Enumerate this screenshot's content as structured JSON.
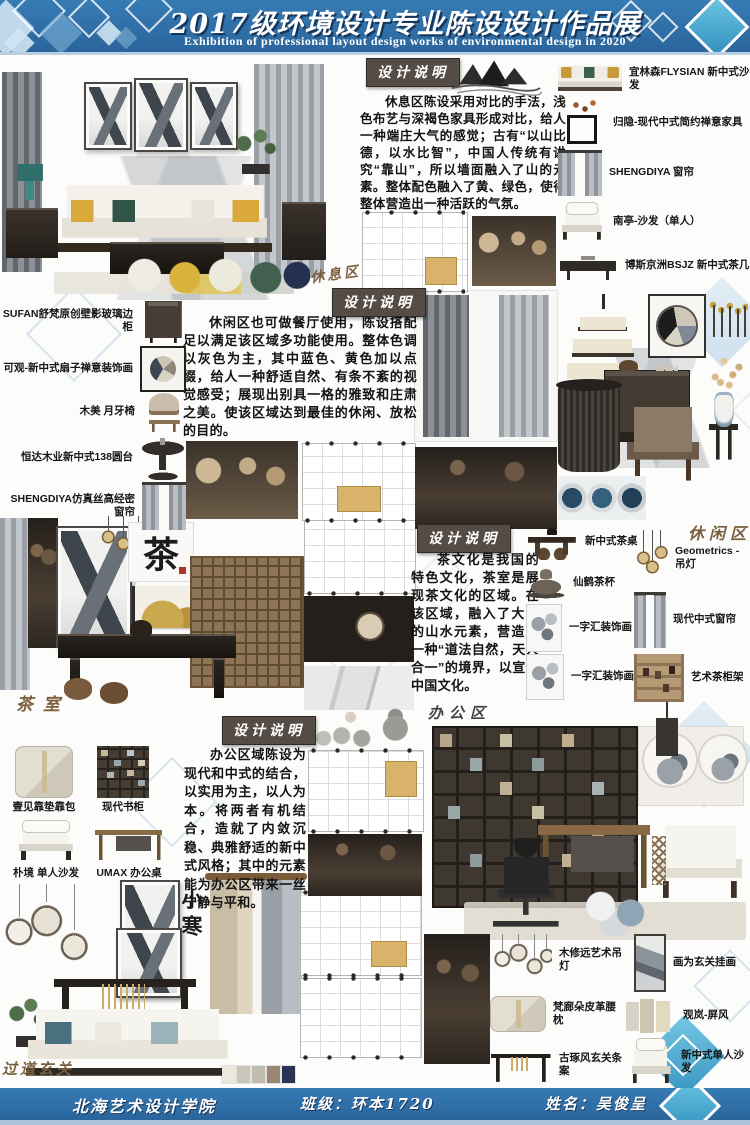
{
  "header": {
    "title": "2017级环境设计专业陈设设计作品展",
    "subtitle": "Exhibition of professional layout design works of environmental design in 2020"
  },
  "sections": {
    "rest_label": "休息区",
    "leisure_label": "休闲区",
    "tea_label": "茶室",
    "office_label": "办公区",
    "hallway_label": "过道玄关",
    "calligraphy_art": "茶",
    "solar_term_art": "小寒"
  },
  "design_notes": [
    {
      "title": "设计说明",
      "body": "休息区陈设采用对比的手法，浅色布艺与深褐色家具形成对比，给人一种端庄大气的感觉；古有“以山比德，以水比智”，中国人传统有讲究“靠山”，所以墙面融入了山的元素。整体配色融入了黄、绿色，使得整体营造出一种活跃的气氛。"
    },
    {
      "title": "设计说明",
      "body": "休闲区也可做餐厅使用，陈设搭配足以满足该区域多功能使用。整体色调以灰色为主，其中蓝色、黄色加以点缀，给人一种舒适自然、有条不紊的视觉感受；展现出别具一格的雅致和庄肃之美。使该区域达到最佳的休闲、放松的目的。"
    },
    {
      "title": "设计说明",
      "body": "茶文化是我国的特色文化，茶室是展现茶文化的区域。在该区域，融入了大量的山水元素，营造出一种“道法自然，天人合一”的境界，以宣传中国文化。"
    },
    {
      "title": "设计说明",
      "body": "办公区域陈设为现代和中式的结合，以实用为主，以人为本。将两者有机结合，造就了内敛沉稳、典雅舒适的新中式风格；其中的元素能为办公区带来一丝宁静与平和。"
    }
  ],
  "products": {
    "rest_right": [
      {
        "label": "宜林森FLYSIAN 新中式沙发"
      },
      {
        "label": "归隐-现代中式简约禅意家具"
      },
      {
        "label": "SHENGDIYA 窗帘"
      },
      {
        "label": "南亭-沙发（单人）"
      },
      {
        "label": "博斯京洲BSJZ 新中式茶几"
      }
    ],
    "leisure_left": [
      {
        "label": "SUFAN舒梵原创壁影玻璃边柜"
      },
      {
        "label": "可观-新中式扇子禅意装饰画"
      },
      {
        "label": "木美 月牙椅"
      },
      {
        "label": "恒达木业新中式138圆台"
      },
      {
        "label": "SHENGDIYA仿真丝高经密窗帘"
      }
    ],
    "tea_mid": [
      {
        "label": "新中式茶桌"
      },
      {
        "label": "仙鹤茶杯"
      },
      {
        "label": "一字汇装饰画"
      },
      {
        "label": "一字汇装饰画"
      }
    ],
    "tea_right": [
      {
        "label": "Geometrics - 吊灯"
      },
      {
        "label": "现代中式窗帘"
      },
      {
        "label": "艺术茶柜架"
      }
    ],
    "office_left": [
      {
        "label": "壹见靠垫靠包"
      },
      {
        "label": "现代书柜"
      },
      {
        "label": "朴境 单人沙发"
      },
      {
        "label": "UMAX 办公桌"
      }
    ],
    "hallway_col1": [
      {
        "label": "木修远艺术吊灯"
      },
      {
        "label": "梵廊朵皮革腰枕"
      },
      {
        "label": "古琢风玄关条案"
      }
    ],
    "hallway_col2": [
      {
        "label": "画为玄关挂画"
      },
      {
        "label": "观岚-屏风"
      },
      {
        "label": "新中式单人沙发"
      }
    ]
  },
  "palette": {
    "header_blue": "#2e6ba3",
    "badge_brown": "#554c45",
    "accent_cyan": "#57b5d9",
    "swatches": [
      "#ece9dc",
      "#c8c6b8",
      "#c0bdae",
      "#9b8573",
      "#2a3356"
    ]
  },
  "footer": {
    "school": "北海艺术设计学院",
    "class_info": "班级：环本1720",
    "name_info": "姓名：吴俊呈"
  }
}
